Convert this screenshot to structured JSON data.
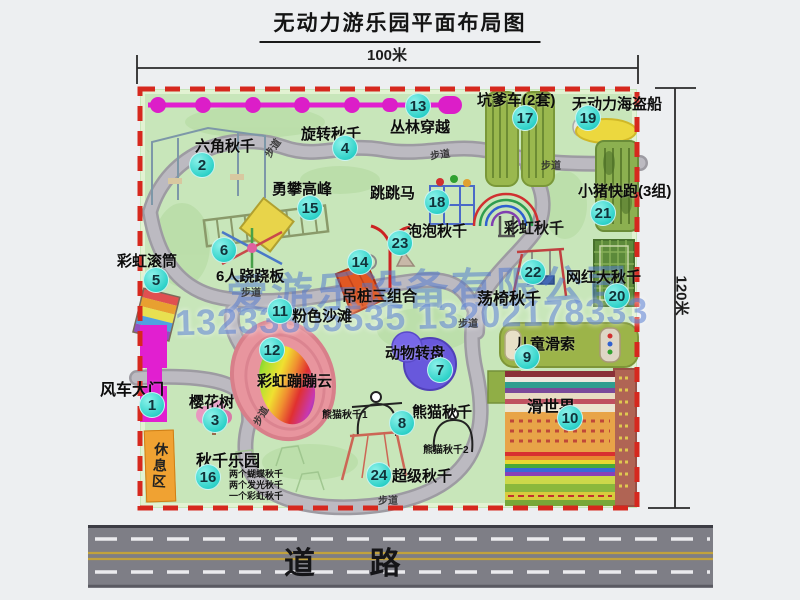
{
  "title": "无动力游乐园平面布局图",
  "dimensions": {
    "top": "100米",
    "right": "120米"
  },
  "road_label": "道    路",
  "rest_area_label": "休息区",
  "watermark": {
    "company": "爱游乐设备有限公司",
    "phone": "13233805535 13202178333"
  },
  "colors": {
    "park_green": "#c8e6ba",
    "border_red": "#d6281e",
    "marker_cyan": "#2fd2c9",
    "gate_magenta": "#e11fd0",
    "watermark_blue": "#4e76d0",
    "rest_area_orange": "#f0a232",
    "road_gray": "#7e7e86",
    "road_line_yellow": "#c2a23c"
  },
  "park": {
    "markers": [
      {
        "n": "1",
        "label": "风车大门",
        "cx": 152,
        "cy": 405,
        "lx": 100,
        "ly": 376,
        "fs": 16
      },
      {
        "n": "2",
        "label": "六角秋千",
        "cx": 202,
        "cy": 165,
        "lx": 195,
        "ly": 135
      },
      {
        "n": "3",
        "label": "樱花树",
        "cx": 215,
        "cy": 420,
        "lx": 189,
        "ly": 391
      },
      {
        "n": "4",
        "label": "旋转秋千",
        "cx": 345,
        "cy": 148,
        "lx": 301,
        "ly": 123
      },
      {
        "n": "5",
        "label": "彩虹滚筒",
        "cx": 156,
        "cy": 280,
        "lx": 117,
        "ly": 250
      },
      {
        "n": "6",
        "label": "6人跷跷板",
        "cx": 224,
        "cy": 250,
        "lx": 216,
        "ly": 265
      },
      {
        "n": "7",
        "label": "动物转盘",
        "cx": 440,
        "cy": 370,
        "lx": 385,
        "ly": 342
      },
      {
        "n": "8",
        "label": "熊猫秋千",
        "cx": 402,
        "cy": 423,
        "lx": 412,
        "ly": 401
      },
      {
        "n": "9",
        "label": "儿童滑索",
        "cx": 527,
        "cy": 357,
        "lx": 515,
        "ly": 333
      },
      {
        "n": "10",
        "label": "滑世界",
        "cx": 570,
        "cy": 418,
        "lx": 527,
        "ly": 393,
        "fs": 16
      },
      {
        "n": "11",
        "label": "粉色沙滩",
        "cx": 280,
        "cy": 311,
        "lx": 292,
        "ly": 305
      },
      {
        "n": "12",
        "label": "彩虹蹦蹦云",
        "cx": 272,
        "cy": 350,
        "lx": 257,
        "ly": 370
      },
      {
        "n": "13",
        "label": "丛林穿越",
        "cx": 418,
        "cy": 106,
        "lx": 390,
        "ly": 116
      },
      {
        "n": "14",
        "label": "吊桩三组合",
        "cx": 360,
        "cy": 262,
        "lx": 342,
        "ly": 285
      },
      {
        "n": "15",
        "label": "勇攀高峰",
        "cx": 310,
        "cy": 208,
        "lx": 272,
        "ly": 178
      },
      {
        "n": "16",
        "label": "秋千乐园",
        "cx": 208,
        "cy": 477,
        "lx": 196,
        "ly": 447,
        "fs": 16
      },
      {
        "n": "17",
        "label": "坑爹车(2套)",
        "cx": 525,
        "cy": 118,
        "lx": 477,
        "ly": 89
      },
      {
        "n": "18",
        "label": "跳跳马",
        "cx": 437,
        "cy": 202,
        "lx": 370,
        "ly": 182
      },
      {
        "n": "19",
        "label": "无动力海盗船",
        "cx": 588,
        "cy": 118,
        "lx": 572,
        "ly": 93
      },
      {
        "n": "20",
        "label": "网红大秋千",
        "cx": 617,
        "cy": 296,
        "lx": 566,
        "ly": 266
      },
      {
        "n": "21",
        "label": "小猪快跑(3组)",
        "cx": 603,
        "cy": 213,
        "lx": 578,
        "ly": 180
      },
      {
        "n": "22",
        "label": "荡椅秋千",
        "cx": 533,
        "cy": 272,
        "lx": 477,
        "ly": 285,
        "fs": 16
      },
      {
        "n": "23",
        "label": "泡泡秋千",
        "cx": 400,
        "cy": 243,
        "lx": 407,
        "ly": 220
      },
      {
        "n": "24",
        "label": "超级秋千",
        "cx": 379,
        "cy": 475,
        "lx": 392,
        "ly": 465
      }
    ],
    "notes": [
      {
        "text": "彩虹秋千",
        "x": 504,
        "y": 217,
        "fs": 15
      },
      {
        "text": "熊猫秋千1",
        "x": 322,
        "y": 406,
        "fs": 10
      },
      {
        "text": "熊猫秋千2",
        "x": 423,
        "y": 441,
        "fs": 10
      },
      {
        "text": "两个蝴蝶秋千",
        "x": 229,
        "y": 467,
        "fs": 9
      },
      {
        "text": "两个发光秋千",
        "x": 229,
        "y": 478,
        "fs": 9
      },
      {
        "text": "一个彩虹秋千",
        "x": 229,
        "y": 489,
        "fs": 9
      }
    ],
    "path_labels": [
      {
        "text": "步道",
        "x": 262,
        "y": 140,
        "rot": -55
      },
      {
        "text": "步道",
        "x": 430,
        "y": 146,
        "rot": -8
      },
      {
        "text": "步道",
        "x": 541,
        "y": 157,
        "rot": 0
      },
      {
        "text": "步道",
        "x": 241,
        "y": 284,
        "rot": 0
      },
      {
        "text": "步道",
        "x": 250,
        "y": 408,
        "rot": -60
      },
      {
        "text": "步道",
        "x": 458,
        "y": 315,
        "rot": 0
      },
      {
        "text": "步道",
        "x": 378,
        "y": 492,
        "rot": 0
      }
    ]
  }
}
